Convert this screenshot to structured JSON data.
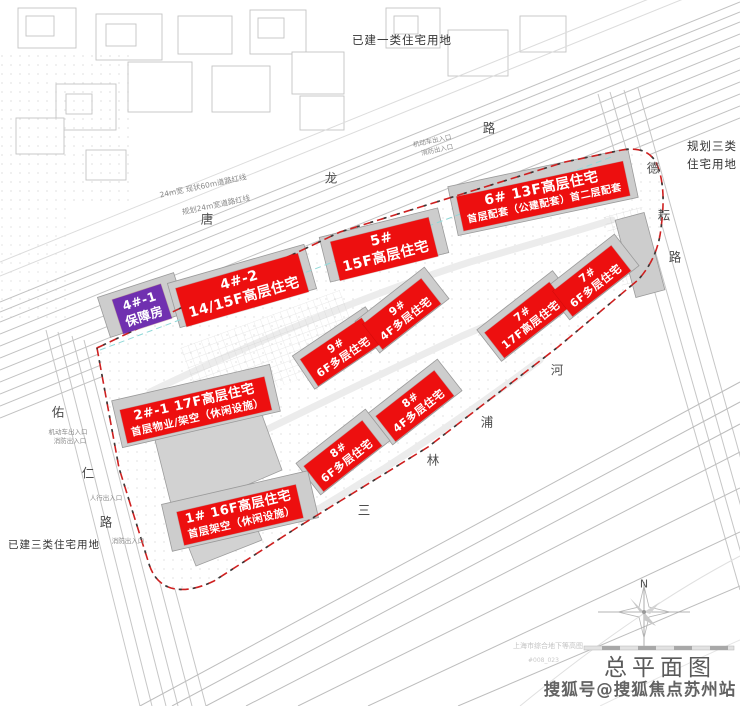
{
  "plan": {
    "title": "总平面图",
    "north_label": "N",
    "archive_note": "上海市综合地下等高图",
    "archive_code": "#008_023"
  },
  "watermark": {
    "text": "搜狐号@搜狐焦点苏州站"
  },
  "zones": {
    "top": "已建一类住宅用地",
    "right_line1": "规划三类",
    "right_line2": "住宅用地",
    "bottom_left": "已建三类住宅用地"
  },
  "colors": {
    "label_red": "#ed0f0f",
    "label_purple": "#7030b0",
    "boundary_red": "#cf2020",
    "building_gray": "#cdcdcd",
    "line_gray": "#c2c2c2",
    "cyan_dash": "#8fd8d8"
  },
  "road_chars": [
    {
      "ch": "唐",
      "x": 207,
      "y": 218
    },
    {
      "ch": "龙",
      "x": 331,
      "y": 177
    },
    {
      "ch": "路",
      "x": 489,
      "y": 127
    },
    {
      "ch": "佑",
      "x": 58,
      "y": 411
    },
    {
      "ch": "仁",
      "x": 88,
      "y": 472
    },
    {
      "ch": "路",
      "x": 106,
      "y": 521
    },
    {
      "ch": "德",
      "x": 653,
      "y": 167
    },
    {
      "ch": "耘",
      "x": 664,
      "y": 214
    },
    {
      "ch": "路",
      "x": 675,
      "y": 256
    },
    {
      "ch": "三",
      "x": 364,
      "y": 509
    },
    {
      "ch": "林",
      "x": 433,
      "y": 459
    },
    {
      "ch": "浦",
      "x": 487,
      "y": 421
    },
    {
      "ch": "河",
      "x": 557,
      "y": 369
    }
  ],
  "annotations": [
    {
      "text": "24m宽 现状60m道路红线",
      "x": 203,
      "y": 186,
      "rot": -12,
      "size": 7.5
    },
    {
      "text": "规划24m宽道路红线",
      "x": 216,
      "y": 205,
      "rot": -12,
      "size": 7.5
    },
    {
      "text": "机动车出入口",
      "x": 432,
      "y": 140,
      "rot": -12,
      "size": 6.5
    },
    {
      "text": "消防出入口",
      "x": 437,
      "y": 149,
      "rot": -12,
      "size": 6.5
    },
    {
      "text": "机动车出入口",
      "x": 68,
      "y": 431,
      "rot": 0,
      "size": 6.5
    },
    {
      "text": "消防出入口",
      "x": 70,
      "y": 440,
      "rot": 0,
      "size": 6.5
    },
    {
      "text": "人行出入口",
      "x": 106,
      "y": 497,
      "rot": 0,
      "size": 6.5
    },
    {
      "text": "消防出入口",
      "x": 128,
      "y": 540,
      "rot": 0,
      "size": 6.5
    }
  ],
  "buildings": [
    {
      "id": "4-1",
      "lines": [
        "4#-1",
        "保障房"
      ],
      "color": "purple",
      "x": 142,
      "y": 309,
      "rot": -18,
      "s1": 12.5,
      "s2": 12.5,
      "w": 54,
      "slab_h": 42
    },
    {
      "id": "4-2",
      "lines": [
        "4#-2",
        "14/15F高层住宅"
      ],
      "color": "red",
      "x": 242,
      "y": 290,
      "rot": -16,
      "s1": 14,
      "s2": 14,
      "w": 116,
      "slab_h": 46
    },
    {
      "id": "5",
      "lines": [
        "5#",
        "15F高层住宅"
      ],
      "color": "red",
      "x": 384,
      "y": 249,
      "rot": -14,
      "s1": 14,
      "s2": 14,
      "w": 96,
      "slab_h": 46
    },
    {
      "id": "6",
      "lines": [
        "6# 13F高层住宅",
        "首层配套（公建配套）首二层配套"
      ],
      "color": "red",
      "x": 543,
      "y": 196,
      "rot": -12,
      "s1": 14,
      "s2": 10,
      "w": 158,
      "slab_h": 50
    },
    {
      "id": "7a",
      "lines": [
        "7#",
        "17F高层住宅"
      ],
      "color": "red",
      "x": 527,
      "y": 320,
      "rot": -38,
      "s1": 11,
      "s2": 11,
      "w": 70,
      "slab_h": 40
    },
    {
      "id": "7b",
      "lines": [
        "7#",
        "6F多层住宅"
      ],
      "color": "red",
      "x": 592,
      "y": 281,
      "rot": -38,
      "s1": 11,
      "s2": 11,
      "w": 62,
      "slab_h": 40
    },
    {
      "id": "9a",
      "lines": [
        "9#",
        "6F多层住宅"
      ],
      "color": "red",
      "x": 340,
      "y": 352,
      "rot": -34,
      "s1": 11,
      "s2": 11,
      "w": 62,
      "slab_h": 40
    },
    {
      "id": "9b",
      "lines": [
        "9#",
        "4F多层住宅"
      ],
      "color": "red",
      "x": 402,
      "y": 314,
      "rot": -38,
      "s1": 11,
      "s2": 11,
      "w": 62,
      "slab_h": 40
    },
    {
      "id": "8a",
      "lines": [
        "8#",
        "4F多层住宅"
      ],
      "color": "red",
      "x": 415,
      "y": 406,
      "rot": -38,
      "s1": 11,
      "s2": 11,
      "w": 62,
      "slab_h": 40
    },
    {
      "id": "8b",
      "lines": [
        "8#",
        "6F多层住宅"
      ],
      "color": "red",
      "x": 343,
      "y": 456,
      "rot": -38,
      "s1": 11,
      "s2": 11,
      "w": 62,
      "slab_h": 40
    },
    {
      "id": "2-1",
      "lines": [
        "2#-1 17F高层住宅",
        "首层物业/架空（休闲设施）"
      ],
      "color": "red",
      "x": 196,
      "y": 410,
      "rot": -13,
      "s1": 13,
      "s2": 10.5,
      "w": 136,
      "slab_h": 48
    },
    {
      "id": "1",
      "lines": [
        "1# 16F高层住宅",
        "首层架空（休闲设施）"
      ],
      "color": "red",
      "x": 240,
      "y": 515,
      "rot": -13,
      "s1": 13,
      "s2": 10.5,
      "w": 124,
      "slab_h": 48
    }
  ]
}
